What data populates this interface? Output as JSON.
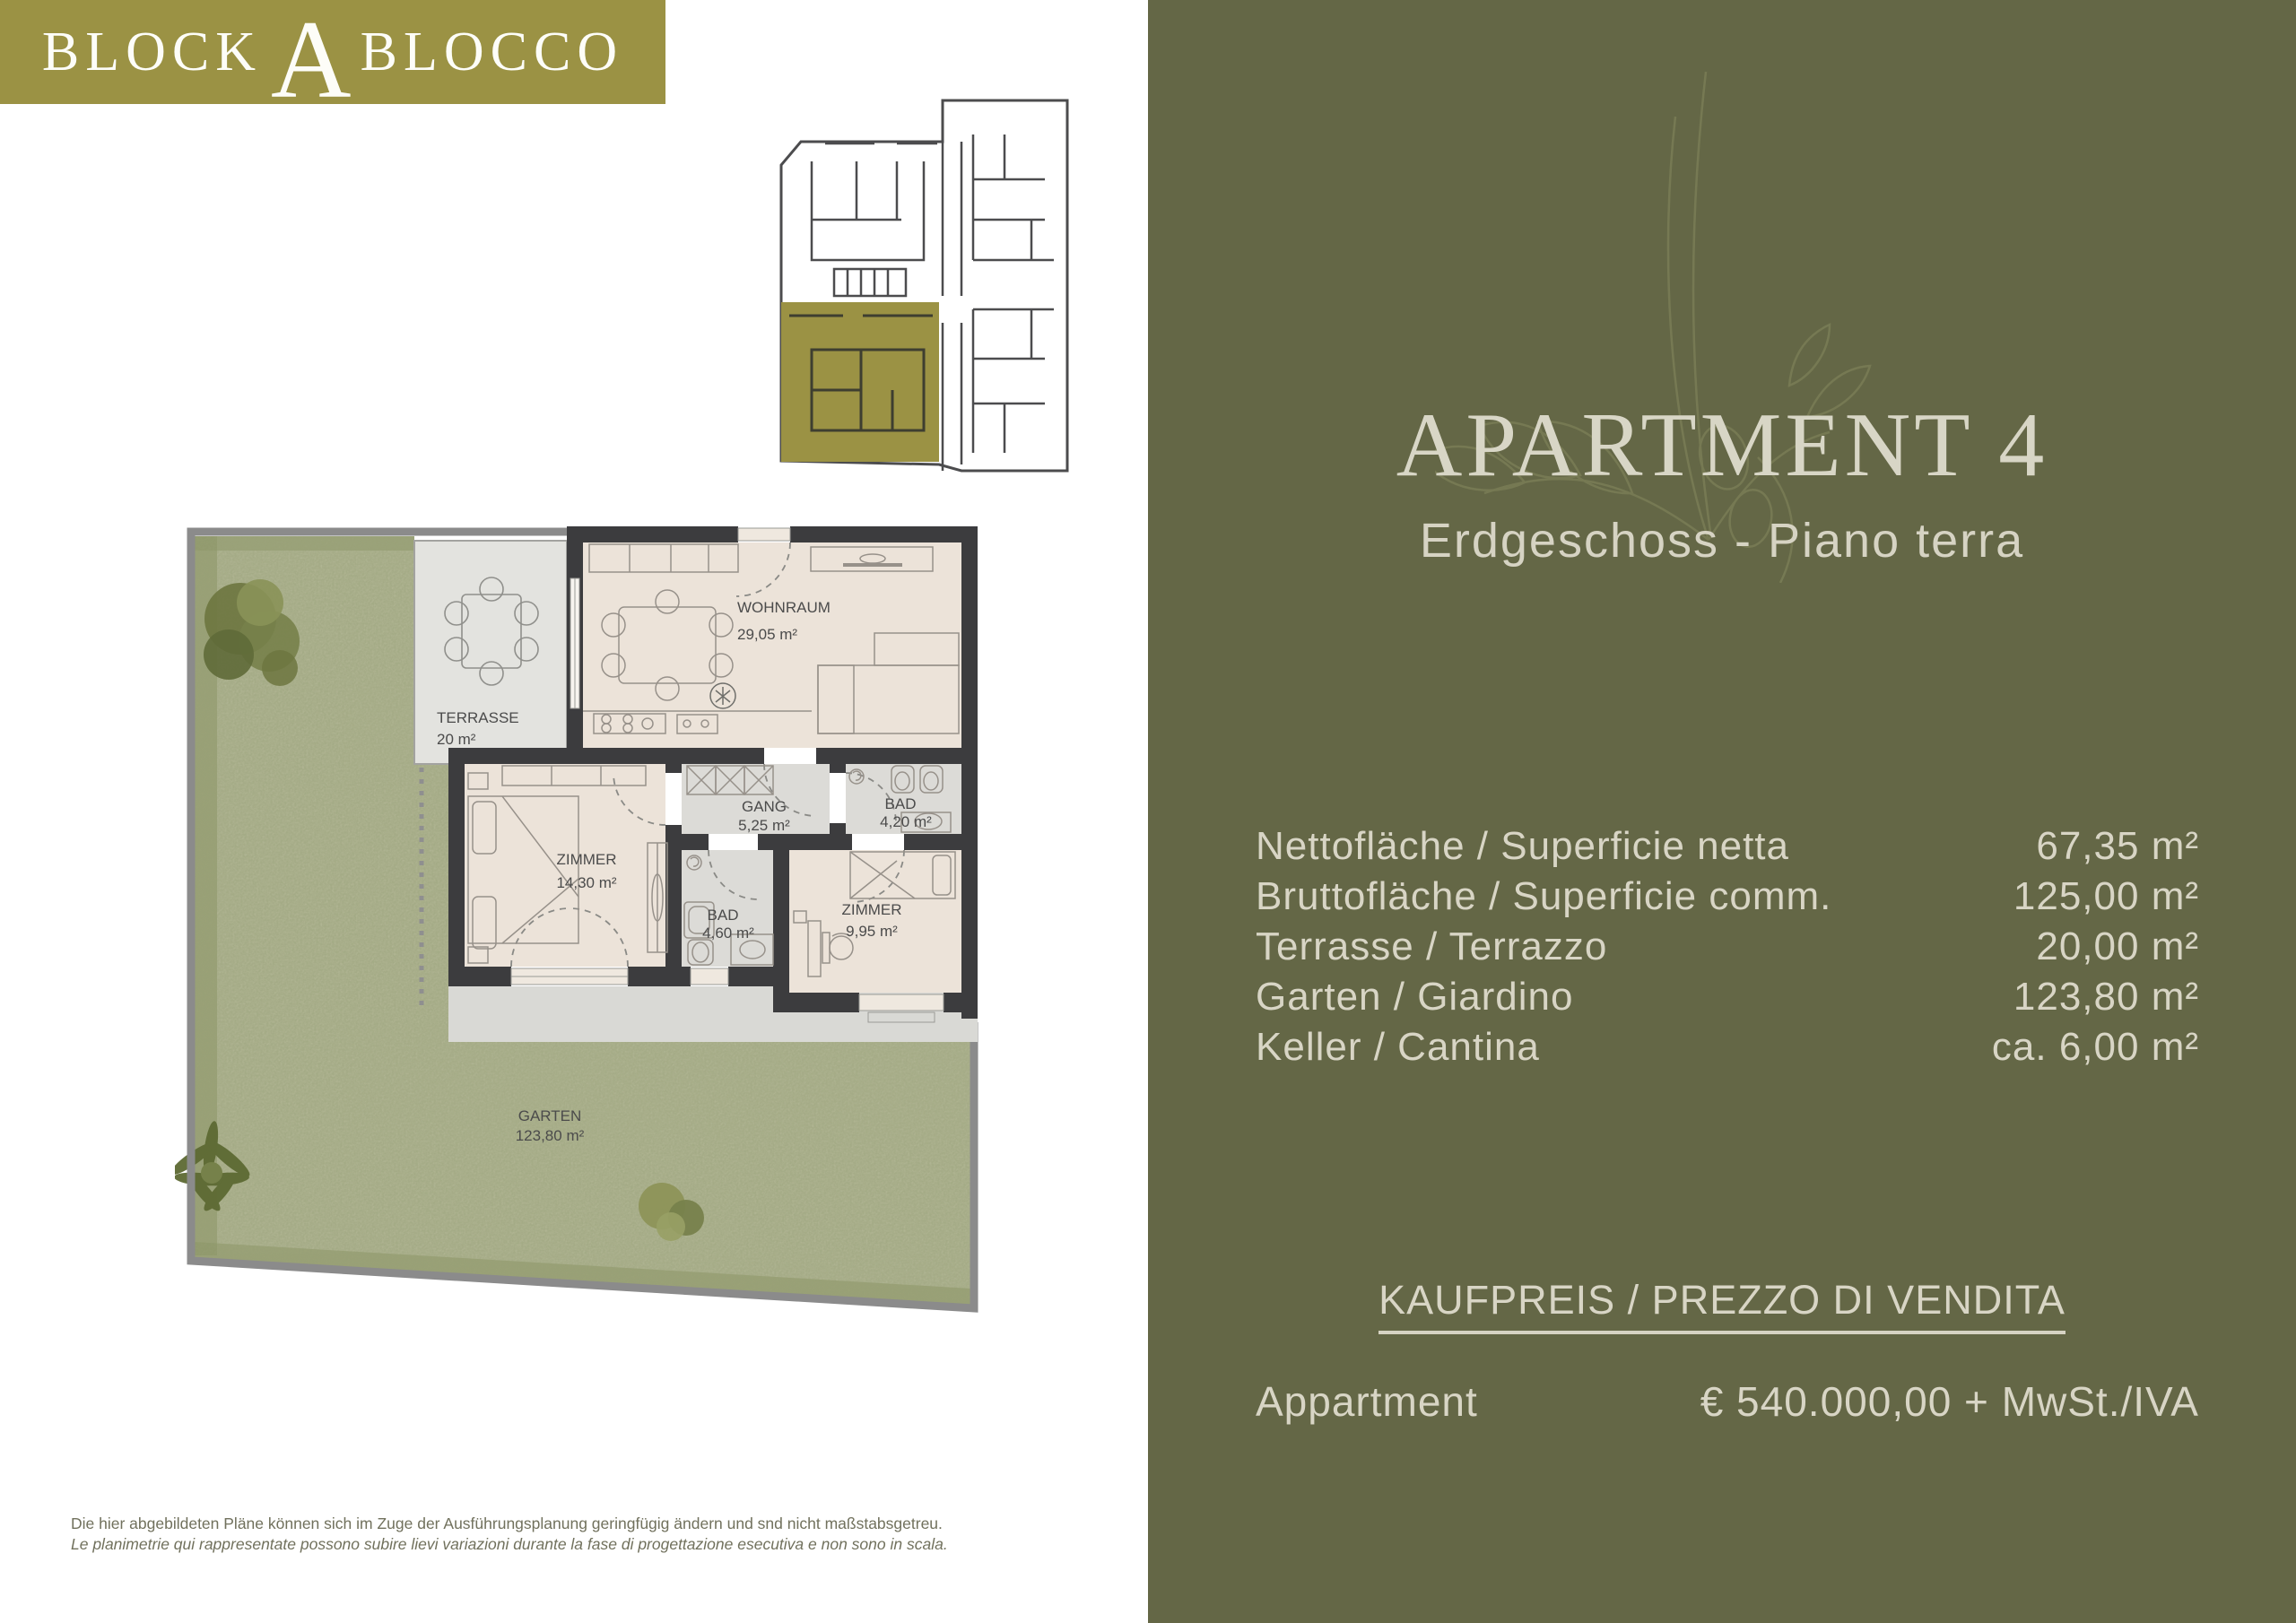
{
  "brand": {
    "name": "BLOCK A BLOCCO",
    "logo_left": "BLOCK",
    "logo_center": "A",
    "logo_right": "BLOCCO",
    "banner_color": "#9b9244"
  },
  "panel": {
    "title": "APARTMENT 4",
    "subtitle": "Erdgeschoss - Piano terra",
    "areas": [
      {
        "label": "Nettofläche / Superficie netta",
        "value": "67,35 m²"
      },
      {
        "label": "Bruttofläche / Superficie comm.",
        "value": "125,00 m²"
      },
      {
        "label": "Terrasse / Terrazzo",
        "value": "20,00 m²"
      },
      {
        "label": "Garten / Giardino",
        "value": "123,80 m²"
      },
      {
        "label": "Keller / Cantina",
        "value": "ca. 6,00 m²"
      }
    ],
    "price_heading": "KAUFPREIS / PREZZO DI VENDITA",
    "price_item": "Appartment",
    "price_value": "€ 540.000,00 + MwSt./IVA",
    "colors": {
      "panel_bg": "#646746",
      "panel_text": "#d8d5c5"
    }
  },
  "floorplan": {
    "labels": {
      "wohnraum": {
        "name": "WOHNRAUM",
        "area": "29,05 m²"
      },
      "terrasse": {
        "name": "TERRASSE",
        "area": "20 m²"
      },
      "gang": {
        "name": "GANG",
        "area": "5,25 m²"
      },
      "bad1": {
        "name": "BAD",
        "area": "4,20 m²"
      },
      "zimmer1": {
        "name": "ZIMMER",
        "area": "14,30 m²"
      },
      "bad2": {
        "name": "BAD",
        "area": "4,60 m²"
      },
      "zimmer2": {
        "name": "ZIMMER",
        "area": "9,95 m²"
      },
      "garten": {
        "name": "GARTEN",
        "area": "123,80 m²"
      }
    },
    "colors": {
      "wall": "#3c3c3e",
      "floor": "#ece3d9",
      "wet_floor": "#dcdbd7",
      "terrace": "#e3e3df",
      "garden": "#b5b998",
      "highlight": "#9b9244"
    }
  },
  "disclaimer": {
    "de": "Die hier abgebildeten Pläne können sich im Zuge der Ausführungsplanung geringfügig ändern und snd nicht maßstabsgetreu.",
    "it": "Le planimetrie qui rappresentate possono subire lievi variazioni durante la fase di progettazione esecutiva e non sono in scala."
  }
}
